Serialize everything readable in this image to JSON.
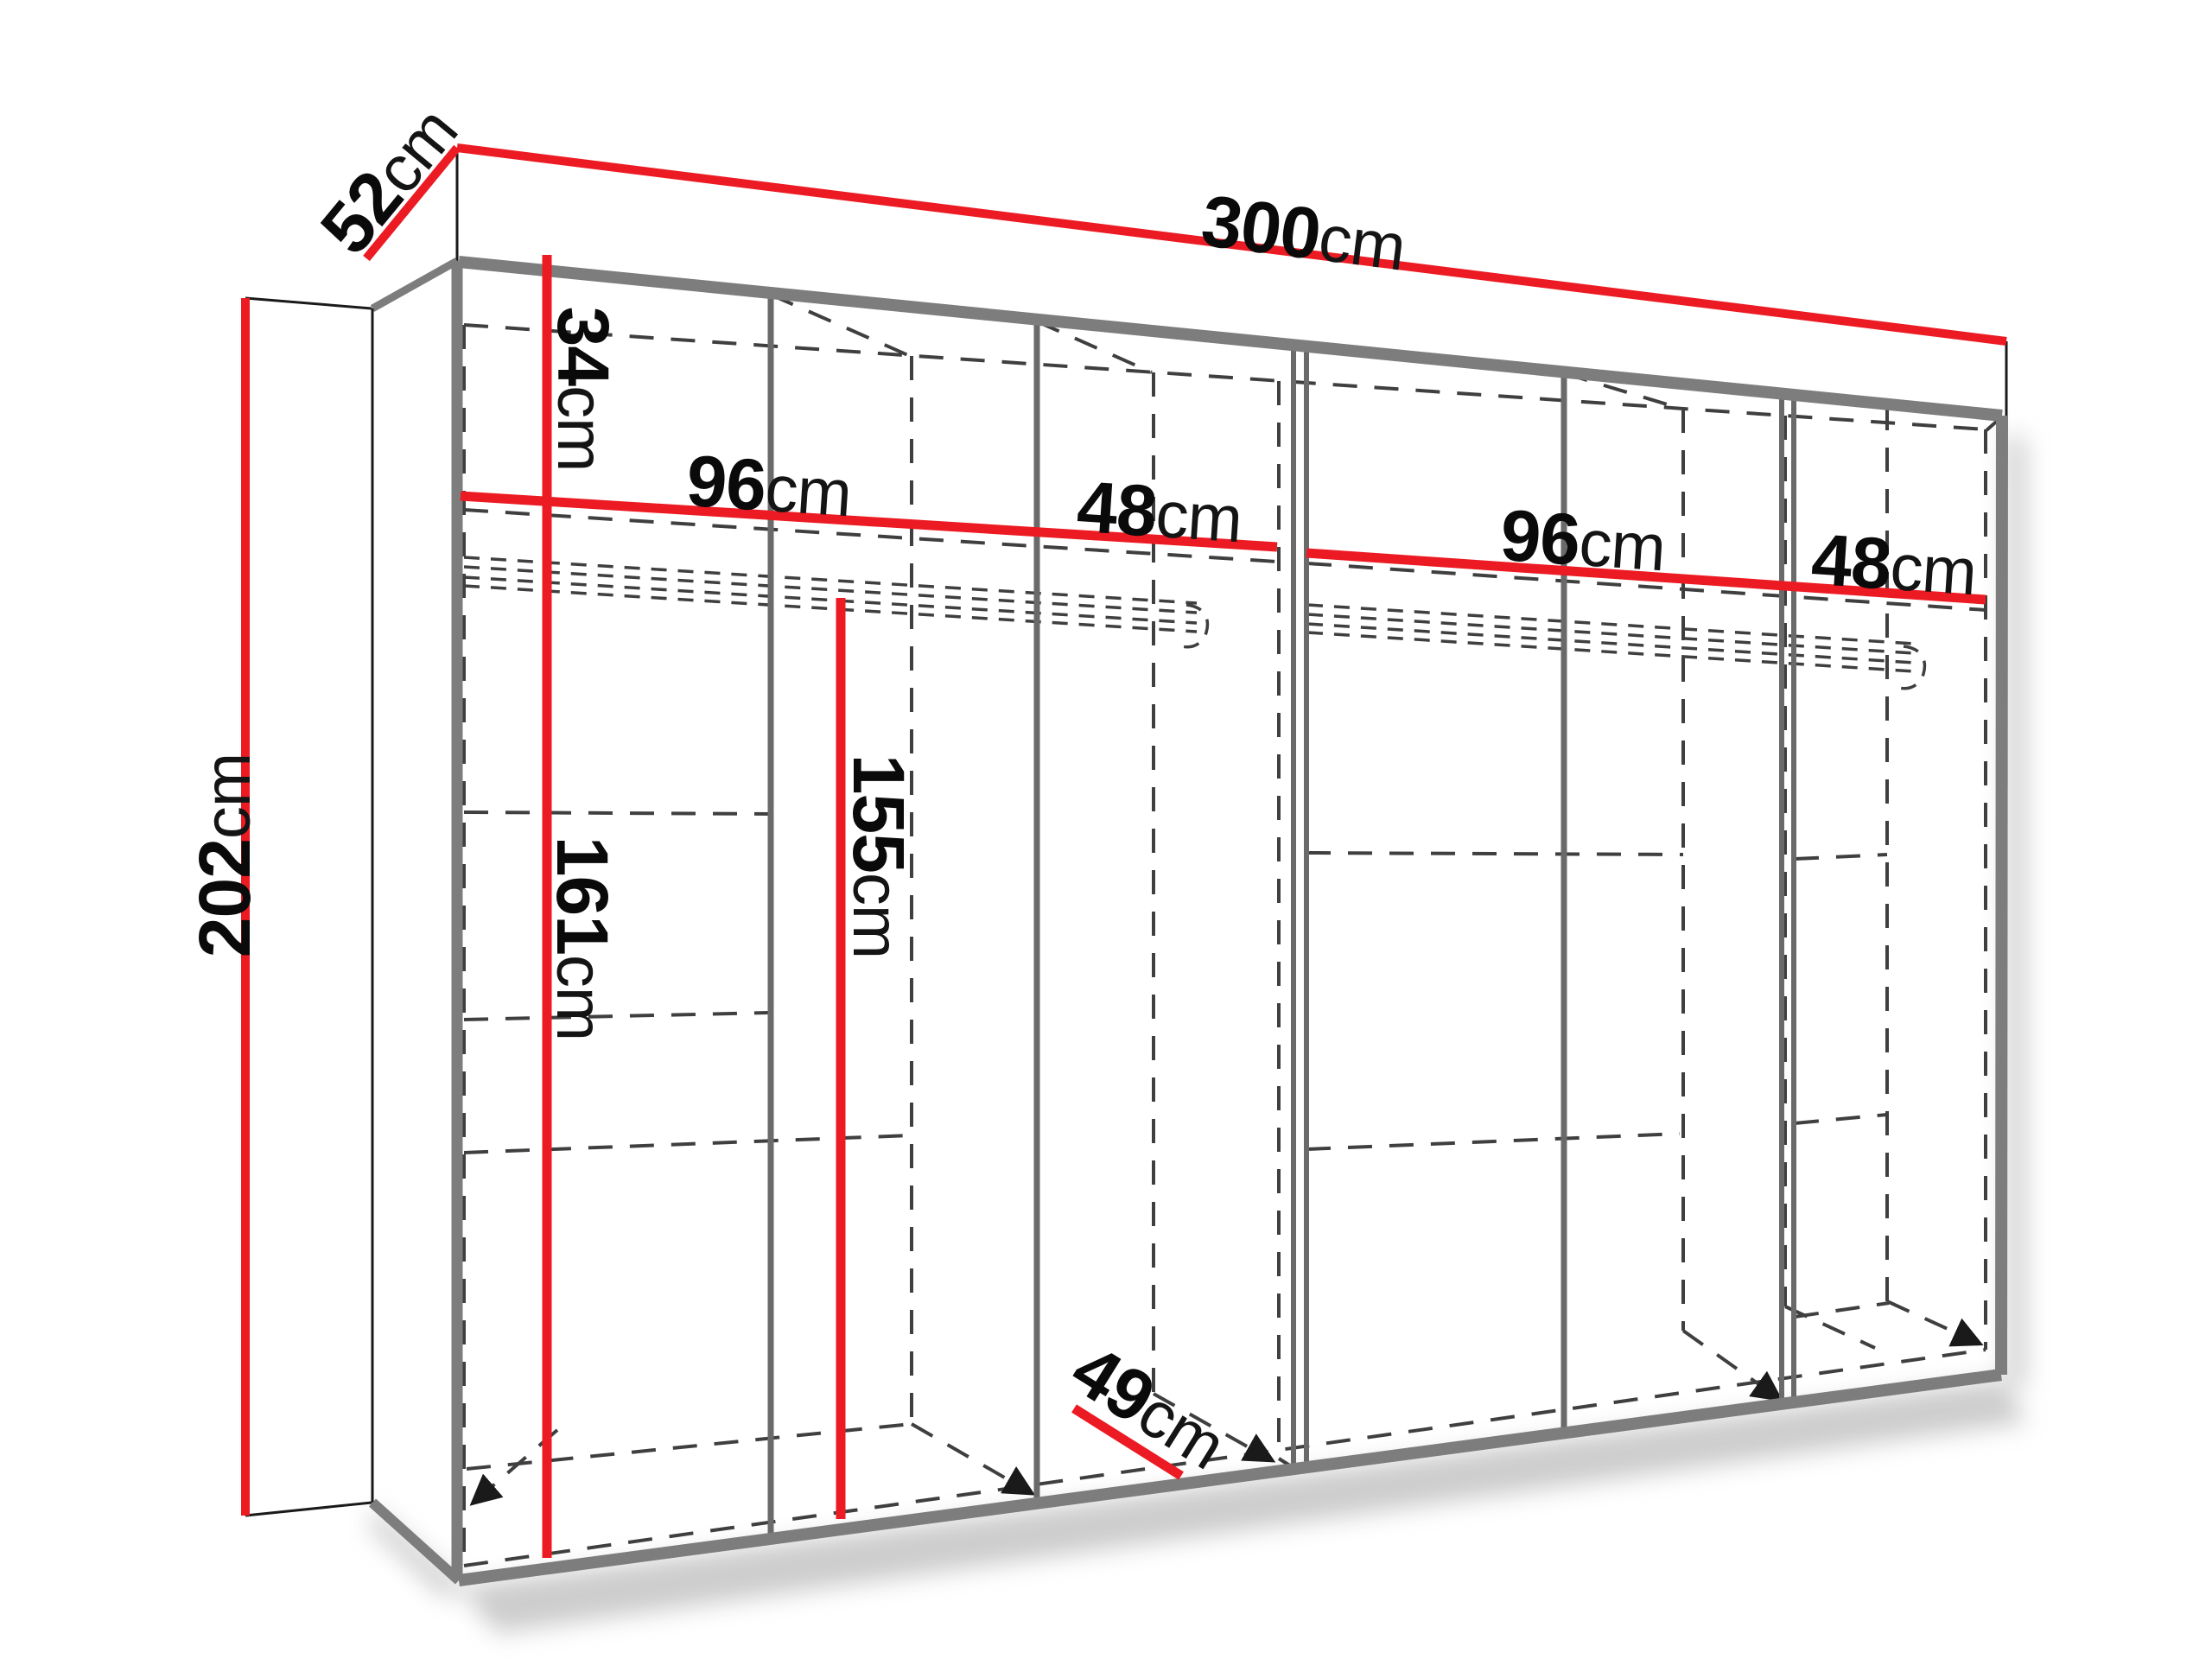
{
  "diagram": {
    "name": "wardrobe-dimension-diagram",
    "colors": {
      "accent_red": "#ec1b23",
      "structure_gray": "#7d7d7d",
      "partition_gray": "#6a6a6a",
      "dashed_gray": "#3f3f3f",
      "outline_black": "#1a1a1a",
      "text_black": "#0a0a0a"
    },
    "dimensions": {
      "width": {
        "value": "300",
        "unit": "cm"
      },
      "depth": {
        "value": "52",
        "unit": "cm"
      },
      "height": {
        "value": "202",
        "unit": "cm"
      },
      "top_shelf": {
        "value": "34",
        "unit": "cm"
      },
      "comp1": {
        "value": "96",
        "unit": "cm"
      },
      "comp2": {
        "value": "48",
        "unit": "cm"
      },
      "comp3": {
        "value": "96",
        "unit": "cm"
      },
      "comp4": {
        "value": "48",
        "unit": "cm"
      },
      "rod_left": {
        "value": "161",
        "unit": "cm"
      },
      "rod_mid": {
        "value": "155",
        "unit": "cm"
      },
      "inner_depth": {
        "value": "49",
        "unit": "cm"
      }
    }
  }
}
